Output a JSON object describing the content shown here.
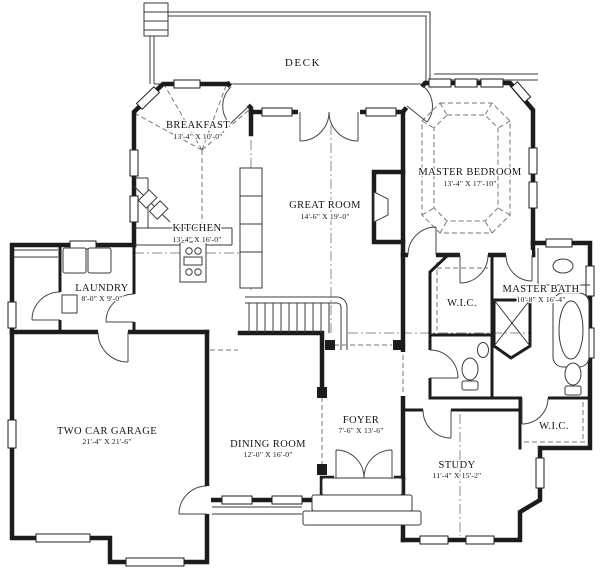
{
  "colors": {
    "wall": "#1c1c1c",
    "thin": "#3a3a3a",
    "dash": "#777777",
    "background": "#ffffff"
  },
  "rooms": [
    {
      "id": "deck",
      "name": "DECK",
      "dims": ""
    },
    {
      "id": "breakfast",
      "name": "BREAKFAST",
      "dims": "13'-4\" X 10'-0\""
    },
    {
      "id": "kitchen",
      "name": "KITCHEN",
      "dims": "13'-4\" X 16'-0\""
    },
    {
      "id": "great-room",
      "name": "GREAT ROOM",
      "dims": "14'-6\" X 19'-0\""
    },
    {
      "id": "master-bedroom",
      "name": "MASTER BEDROOM",
      "dims": "13'-4\" X 17'-10\""
    },
    {
      "id": "laundry",
      "name": "LAUNDRY",
      "dims": "8'-0\" X 9'-0\""
    },
    {
      "id": "wic-1",
      "name": "W.I.C.",
      "dims": ""
    },
    {
      "id": "master-bath",
      "name": "MASTER BATH",
      "dims": "10'-8\" X 16'-4\""
    },
    {
      "id": "garage",
      "name": "TWO CAR GARAGE",
      "dims": "21'-4\" X 21'-6\""
    },
    {
      "id": "dining-room",
      "name": "DINING ROOM",
      "dims": "12'-0\" X 16'-0\""
    },
    {
      "id": "foyer",
      "name": "FOYER",
      "dims": "7'-6\" X 13'-6\""
    },
    {
      "id": "study",
      "name": "STUDY",
      "dims": "11'-4\" X 15'-2\""
    },
    {
      "id": "wic-2",
      "name": "W.I.C.",
      "dims": ""
    }
  ]
}
